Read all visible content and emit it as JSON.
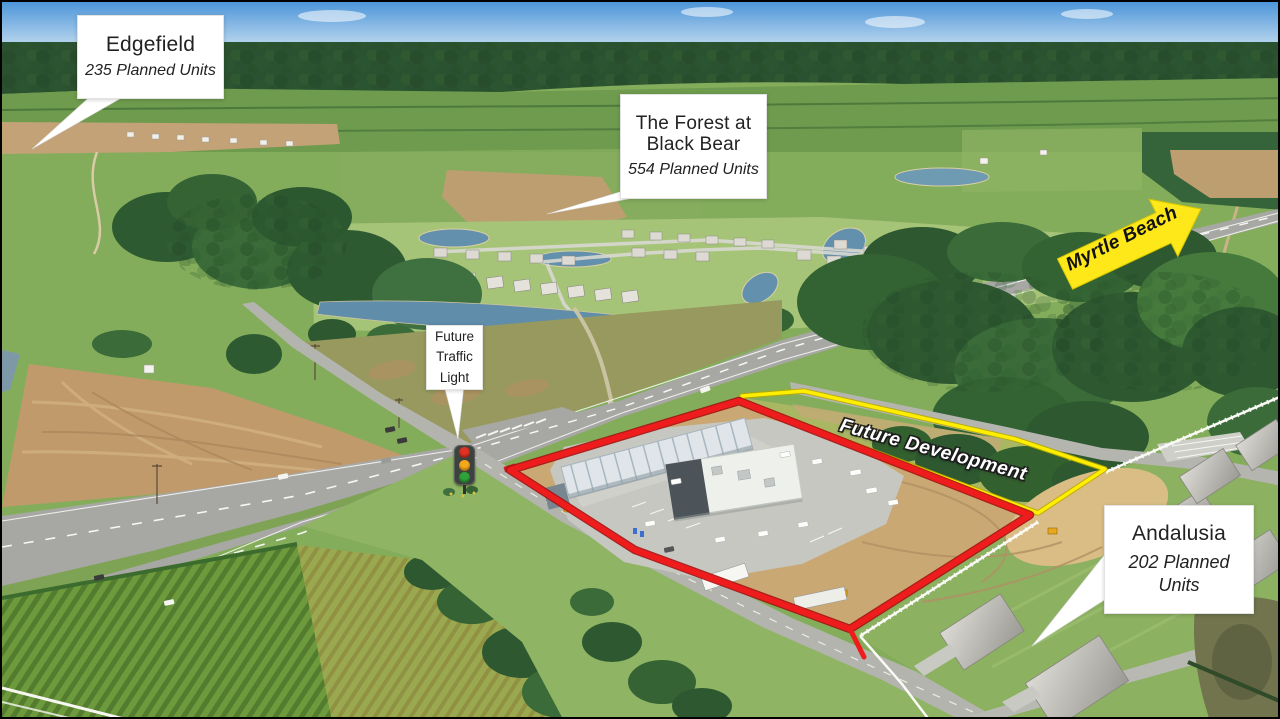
{
  "callouts": {
    "edgefield": {
      "title": "Edgefield",
      "units": "235 Planned Units"
    },
    "forest_at_black_bear": {
      "title_line1": "The Forest at",
      "title_line2": "Black Bear",
      "units": "554 Planned Units"
    },
    "future_traffic_light": {
      "line1": "Future",
      "line2": "Traffic",
      "line3": "Light"
    },
    "andalusia": {
      "title": "Andalusia",
      "units_line1": "202 Planned",
      "units_line2": "Units"
    }
  },
  "labels": {
    "myrtle_beach_arrow": "Myrtle Beach",
    "future_development": "Future Development"
  },
  "colors": {
    "site_outline_red": "#ee1c1c",
    "future_parcel_outline_yellow": "#ffee00",
    "direction_arrow_yellow": "#ffe81a",
    "arrow_text": "#111111",
    "callout_background": "#ffffff",
    "callout_text": "#222222",
    "future_development_text": "#ffffff",
    "traffic_light_housing": "#3d423f",
    "traffic_light_red": "#e03222",
    "traffic_light_amber": "#f5a81c",
    "traffic_light_green": "#2fa33a"
  }
}
